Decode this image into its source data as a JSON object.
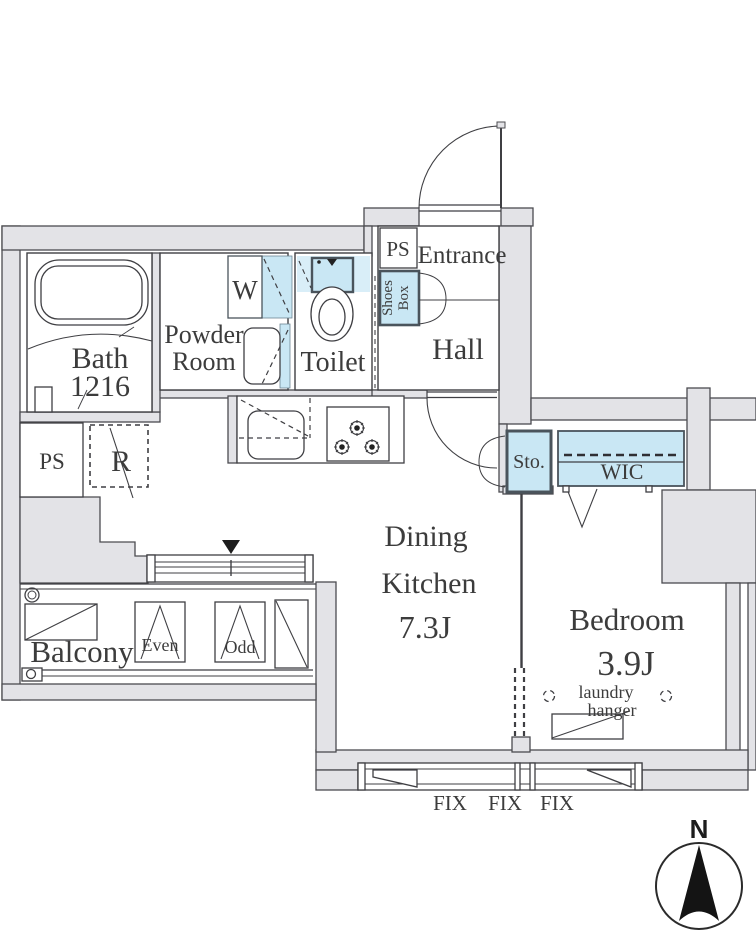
{
  "title": "1DK apartment floor plan",
  "colors": {
    "wall_fill": "#e3e3e7",
    "line": "#3f3f43",
    "fixture_blue": "#c9e7f4",
    "fixture_blue_light": "#d9eef8",
    "dark_border": "#4a545c",
    "text": "#3c3c3c"
  },
  "rooms": {
    "bath": {
      "label": "Bath",
      "size": "1216"
    },
    "powder_room": {
      "line1": "Powder",
      "line2": "Room"
    },
    "toilet": {
      "label": "Toilet"
    },
    "entrance": {
      "label": "Entrance"
    },
    "hall": {
      "label": "Hall"
    },
    "dining_kitchen": {
      "line1": "Dining",
      "line2": "Kitchen",
      "size": "7.3J"
    },
    "bedroom": {
      "label": "Bedroom",
      "size": "3.9J"
    },
    "balcony": {
      "label": "Balcony"
    },
    "wic": {
      "label": "WIC"
    },
    "storage": {
      "label": "Sto."
    }
  },
  "fixtures": {
    "washer": "W",
    "refrigerator": "R",
    "ps_top": "PS",
    "ps_left": "PS",
    "shoes_box": {
      "line1": "Shoes",
      "line2": "Box"
    },
    "laundry_hanger": {
      "line1": "laundry",
      "line2": "hanger"
    },
    "balcony_panels": {
      "even": "Even",
      "odd": "Odd"
    },
    "windows": {
      "fix1": "FIX",
      "fix2": "FIX",
      "fix3": "FIX"
    }
  },
  "compass": {
    "north": "N"
  }
}
